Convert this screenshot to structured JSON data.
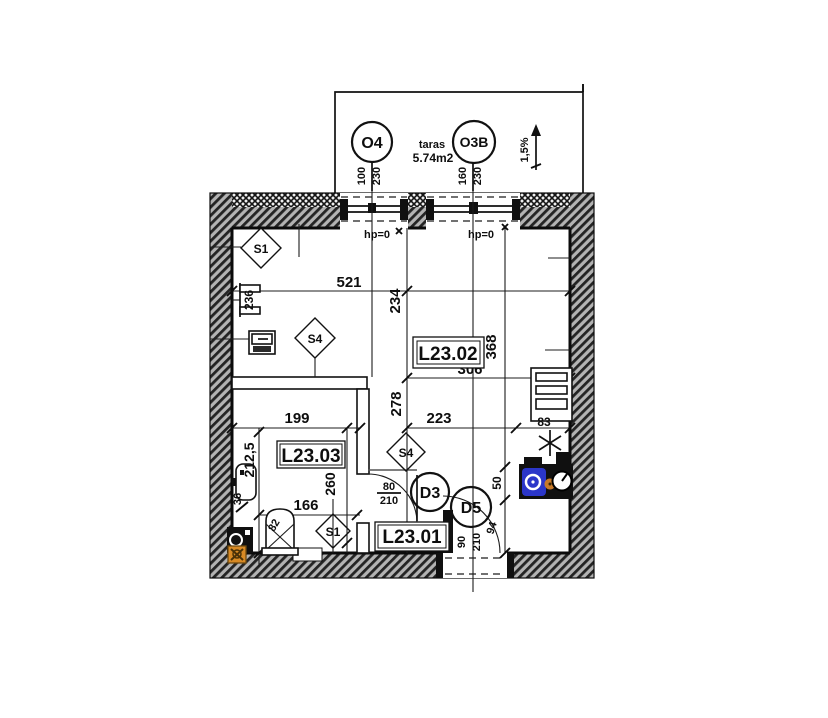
{
  "plan": {
    "terrace": {
      "label": "taras",
      "area": "5.74m2",
      "slope": "1,5%"
    },
    "windows": [
      {
        "id": "O4",
        "width": "100",
        "height": "230",
        "sill": "hp=0"
      },
      {
        "id": "O3B",
        "width": "160",
        "height": "230",
        "sill": "hp=0"
      }
    ],
    "rooms": [
      {
        "id": "L23.02"
      },
      {
        "id": "L23.03"
      },
      {
        "id": "L23.01"
      }
    ],
    "doors": [
      {
        "id": "D3",
        "width": "80",
        "height": "210"
      },
      {
        "id": "D5",
        "width": "90",
        "height": "210"
      }
    ],
    "symbols": [
      {
        "id": "S1"
      },
      {
        "id": "S4"
      },
      {
        "id": "S4"
      },
      {
        "id": "S1"
      }
    ],
    "dims": {
      "room_width": "521",
      "room_depth": "234",
      "right_depth": "368",
      "kitchen_width": "306",
      "hall_depth": "278",
      "hall_width": "223",
      "bath_width": "199",
      "bath_depth": "212,5",
      "bath_inner_depth": "260",
      "bath_lower_width": "166",
      "radiator_width": "236",
      "basin_width": "36",
      "toilet_width": "82",
      "fridge_width": "83",
      "door_offset": "50",
      "entry_offset": "94"
    },
    "colors": {
      "sink_blue": "#2b36c9",
      "accent_orange": "#d88a25"
    }
  }
}
